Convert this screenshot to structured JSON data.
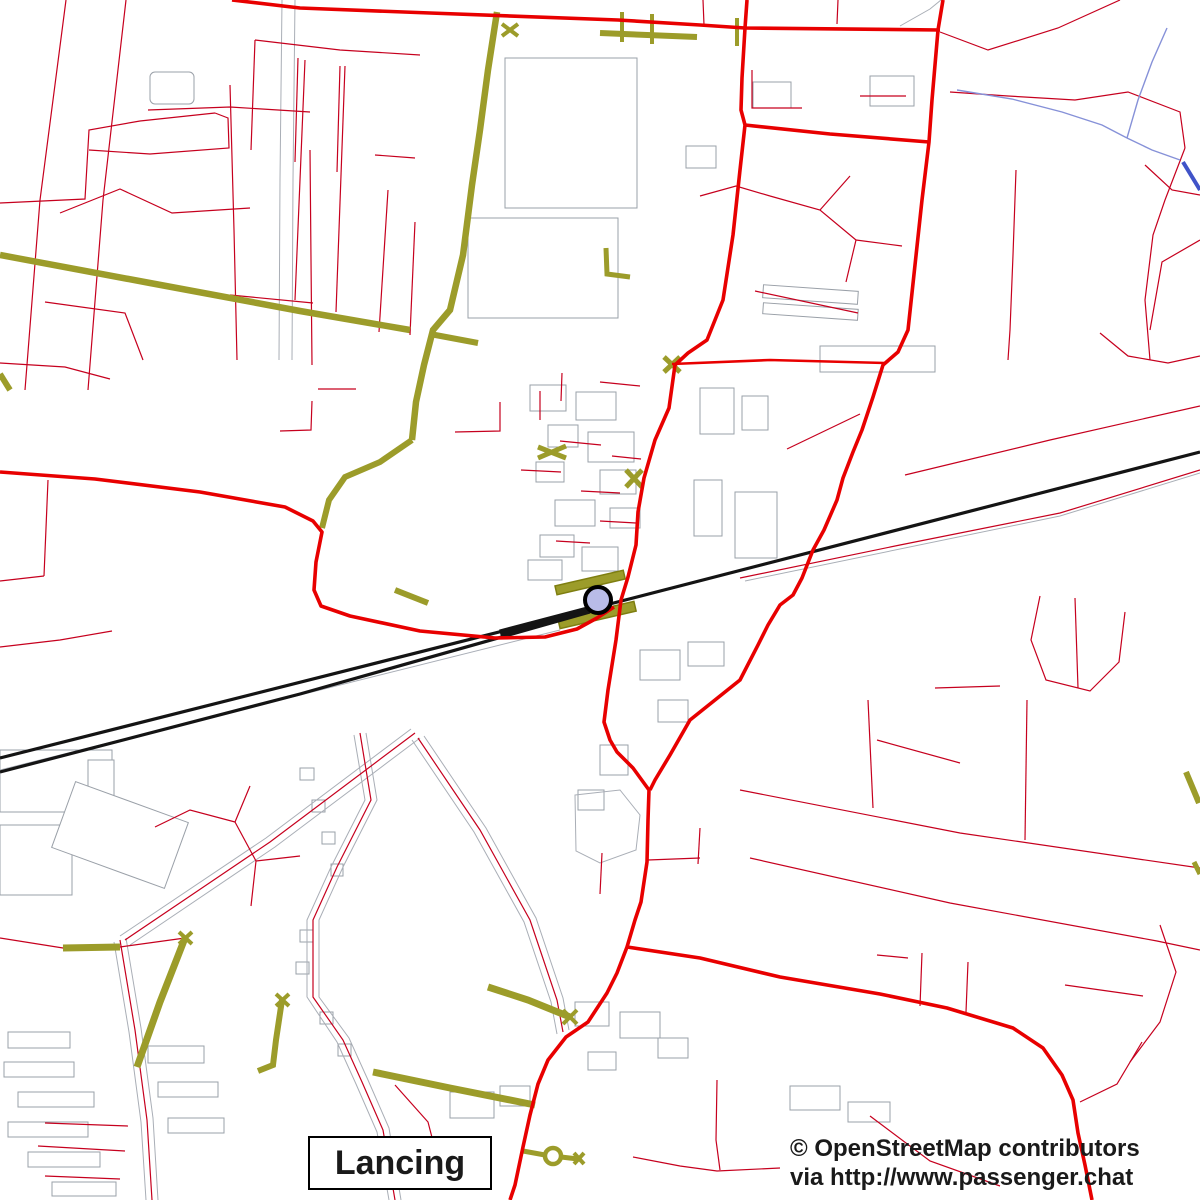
{
  "map": {
    "place_label": "Lancing",
    "marker_icon": "railway-station-circle-marker"
  },
  "attribution": {
    "line1": "© OpenStreetMap contributors",
    "line2": "via http://www.passenger.chat"
  },
  "colors": {
    "primary_road": "#e80000",
    "minor_road": "#c6001e",
    "path_olive": "#9c9c2a",
    "railway": "#141414",
    "water": "#8691d8",
    "water_bold": "#4053c8",
    "casing": "#a9aeb6",
    "building": "#9aa0a8",
    "marker_fill": "#b9bce8",
    "marker_stroke": "#000000",
    "label_bg": "#ffffff",
    "label_border": "#000000"
  }
}
